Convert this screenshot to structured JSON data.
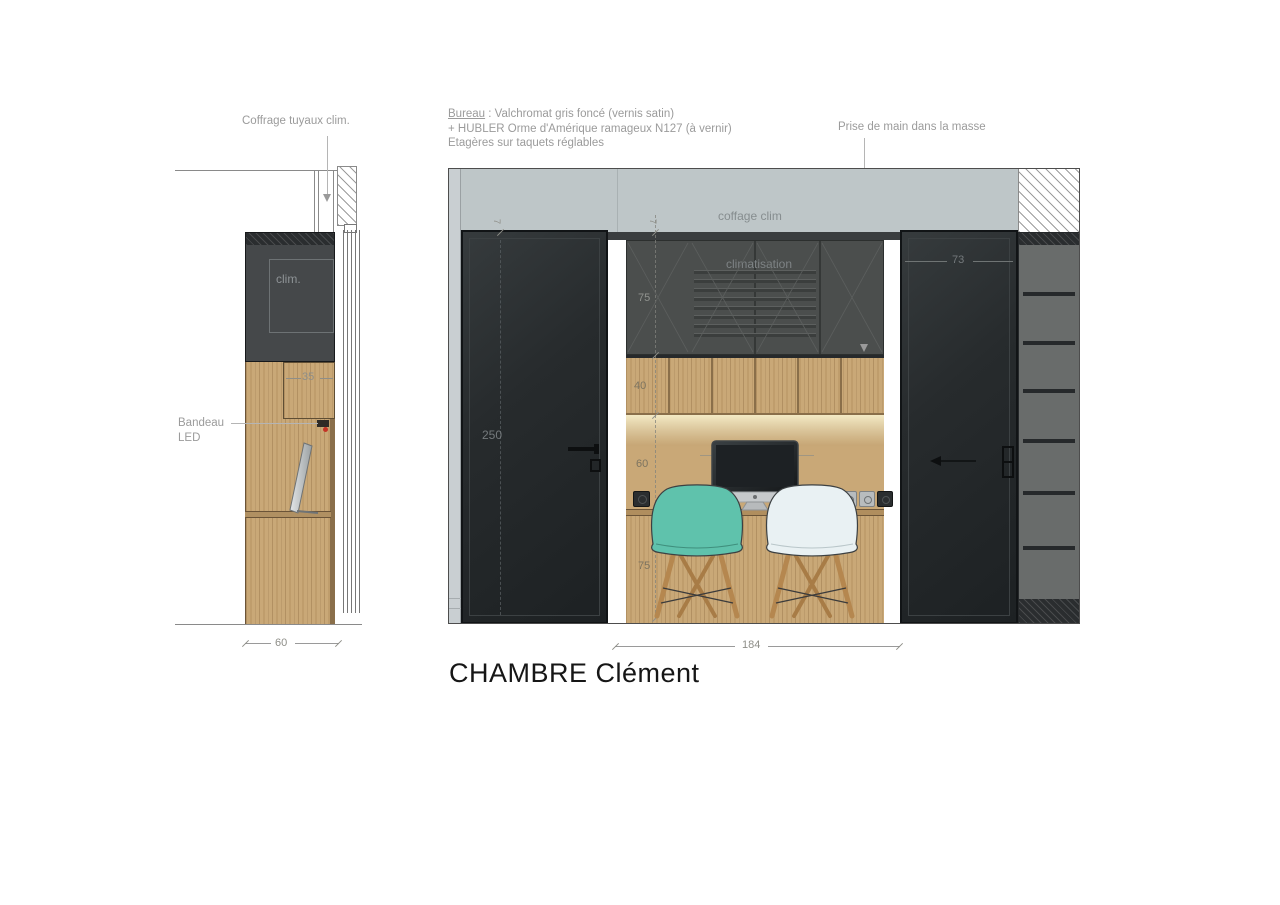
{
  "title": "CHAMBRE Clément",
  "annotations": {
    "coffrage_pipes": "Coffrage tuyaux clim.",
    "bureau_term": "Bureau",
    "bureau_rest": " : Valchromat gris foncé (vernis satin)",
    "bureau_line2": "+ HUBLER Orme d'Amérique ramageux N127 (à vernir)",
    "bureau_line3": "Etagères sur taquets réglables",
    "prise_main": "Prise de main dans la masse",
    "bandeau_word1": "Bandeau",
    "bandeau_word2": "LED",
    "coffage_clim": "coffage clim",
    "climatisation": "climatisation",
    "clim_unit": "clim."
  },
  "dimensions": {
    "section_depth": "60",
    "box_depth": "35",
    "door_height": "250",
    "gap_left": "7",
    "gap_niche": "7",
    "upper_cabinet_height": "75",
    "shelf_zone_height": "40",
    "desk_clearance": "60",
    "desk_length": "170",
    "desk_height": "75",
    "door_width": "73",
    "niche_width": "184"
  },
  "colors": {
    "wall_band": "#bec6c8",
    "door_dark": "#24282a",
    "upper_cabinet": "#4b4e4d",
    "wood": "#c9a877",
    "chair_teal": "#5fc2ac",
    "chair_white": "#e9f1f3",
    "led_glow": "#f7eec9",
    "annotation_gray": "#9b9b9b"
  }
}
